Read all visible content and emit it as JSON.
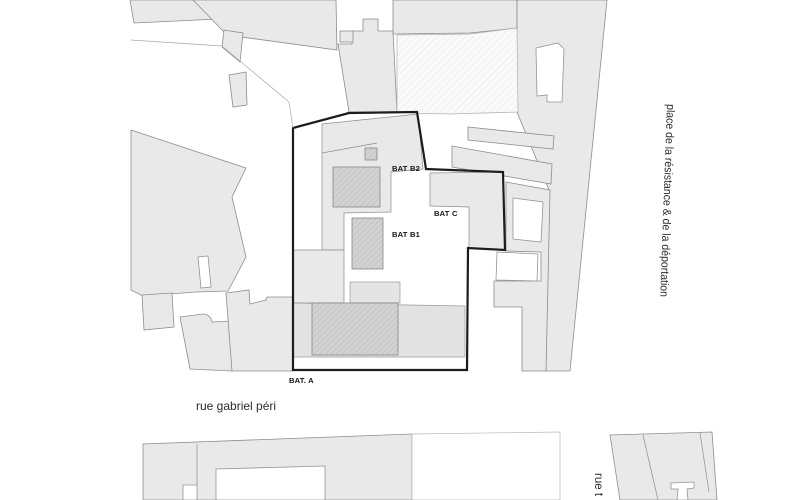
{
  "plan": {
    "type": "architectural-site-plan",
    "labels": {
      "bat_b2": "BAT B2",
      "bat_c": "BAT C",
      "bat_b1": "BAT B1",
      "bat_a": "BAT. A"
    },
    "streets": {
      "rue_gabriel_peri": "rue gabriel péri",
      "place": "place de la résistance & de la déportation",
      "rue_partial": "rue t"
    },
    "colors": {
      "background": "#ffffff",
      "parcel_fill": "#e9e9e9",
      "parcel_stroke": "#8d8d8d",
      "site_boundary": "#1c1c1c",
      "building_fill": "#d2d2d2",
      "building_hatch": "#c0c0c0",
      "label_color": "#141414"
    }
  }
}
